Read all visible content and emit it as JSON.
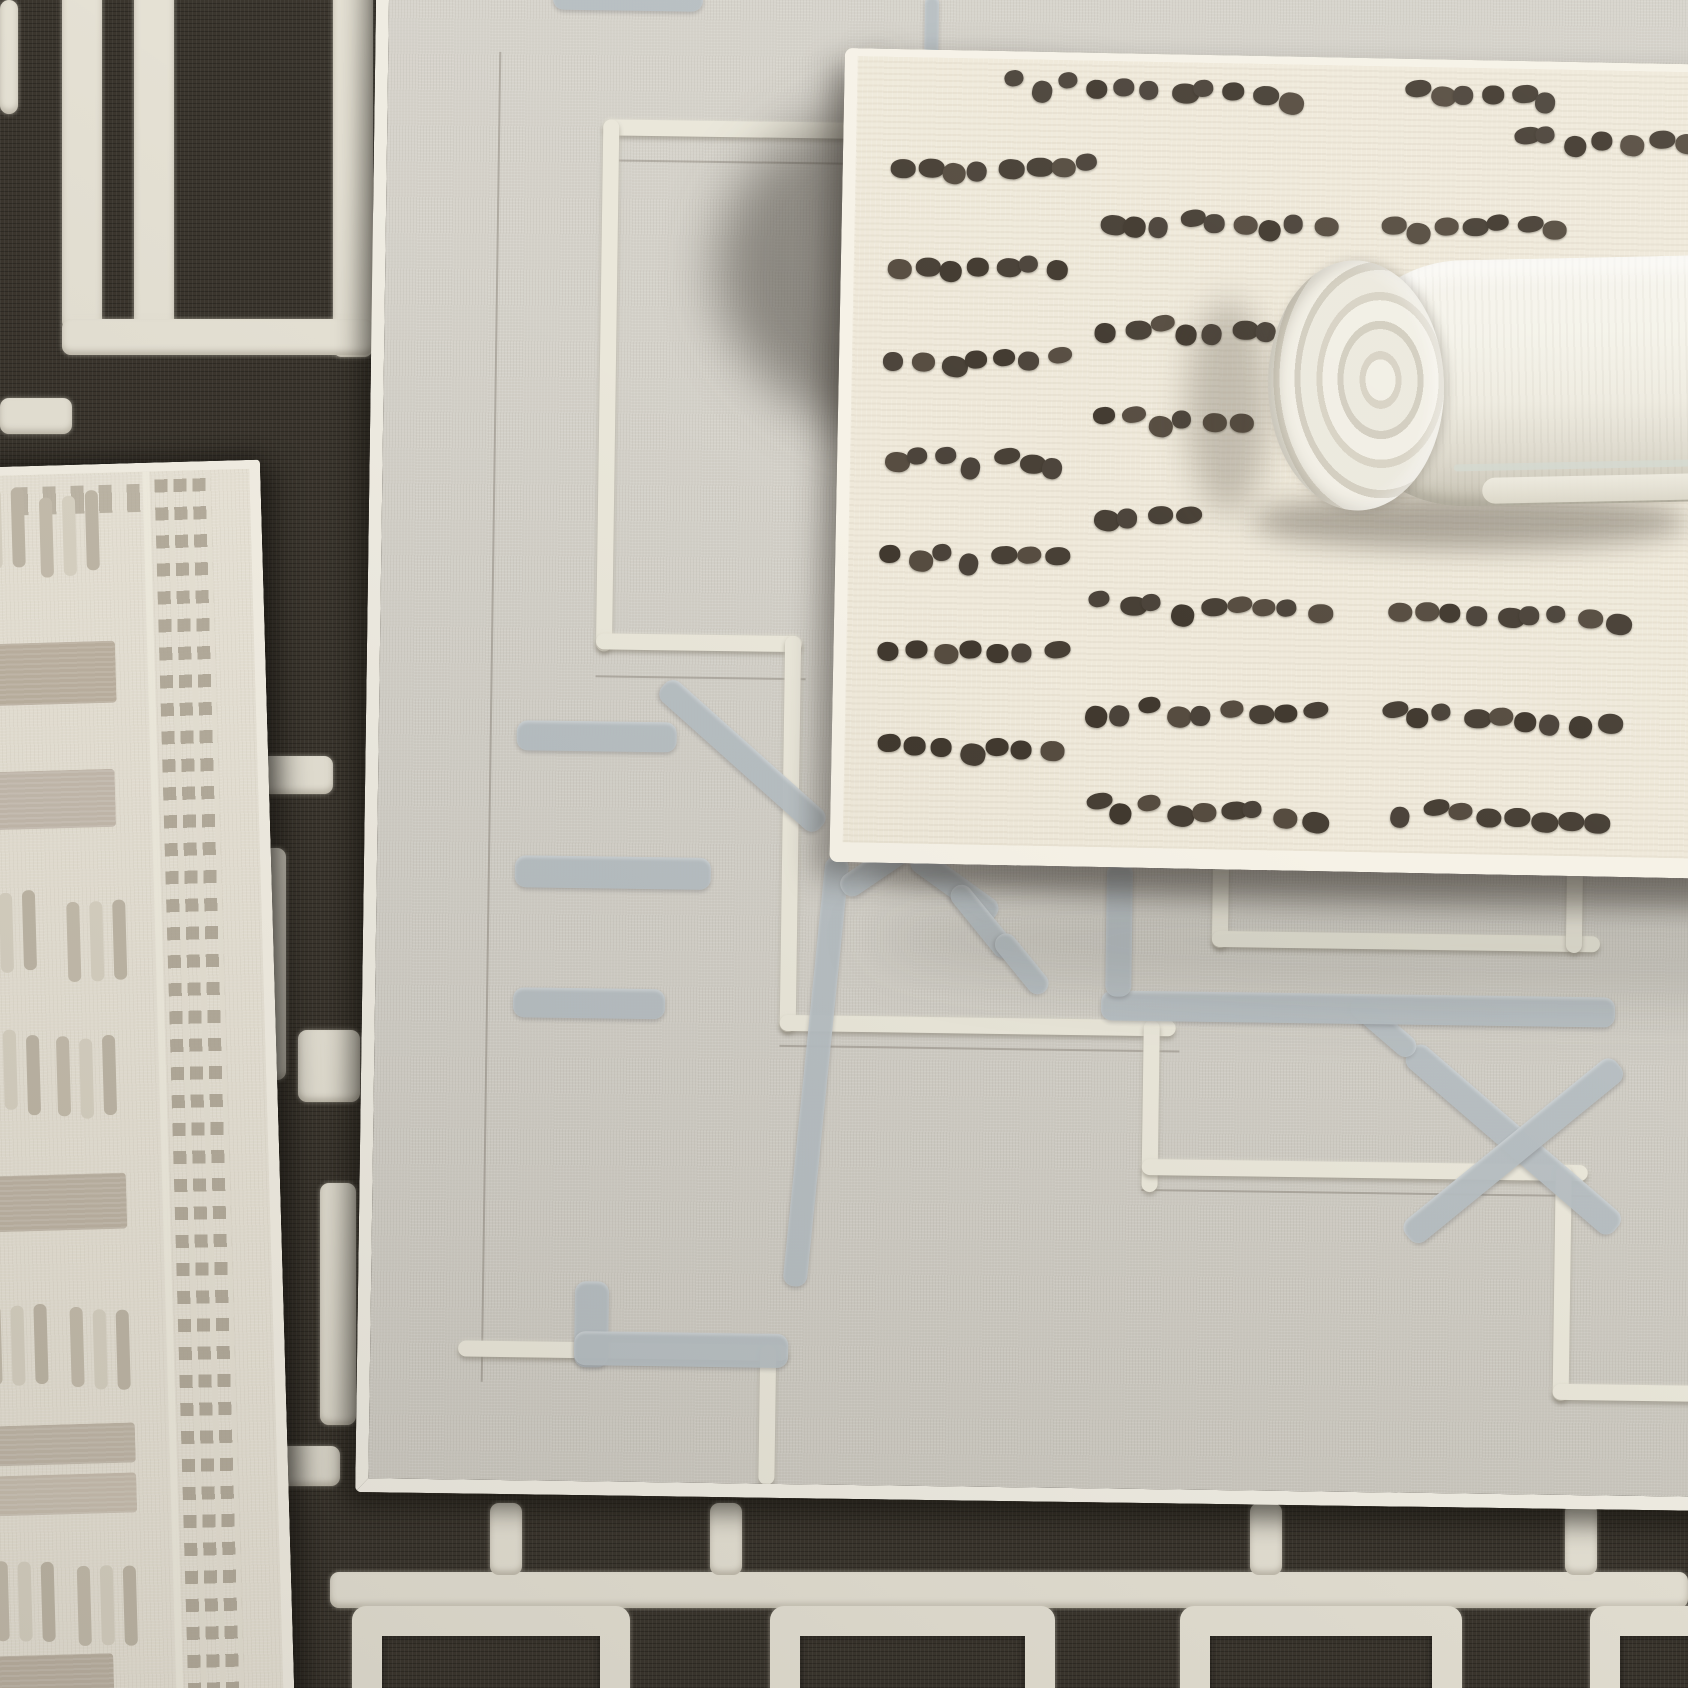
{
  "palette": {
    "dark_rug_base": "#3a352d",
    "dark_rug_pattern": "#e5e1d4",
    "gray_rug_base": "#d2cfc7",
    "gray_rug_lines": "#eae7da",
    "gray_rug_motifs": "#b6bec2",
    "cream_rug_base": "#efe9da",
    "cream_rug_dots": "#4a4238",
    "beige_rug_base": "#e8e3d6",
    "beige_rug_taupe": "#bcb2a2",
    "roll_fabric": "#f4f2e9"
  },
  "dark_rug": {
    "bars": [
      {
        "x": 0,
        "y": 0,
        "w": 18,
        "h": 114
      },
      {
        "x": 62,
        "y": -20,
        "w": 40,
        "h": 350
      },
      {
        "x": 134,
        "y": -20,
        "w": 40,
        "h": 350
      },
      {
        "x": 333,
        "y": -20,
        "w": 40,
        "h": 377
      },
      {
        "x": 62,
        "y": 319,
        "w": 311,
        "h": 36
      },
      {
        "x": 0,
        "y": 398,
        "w": 72,
        "h": 36
      },
      {
        "x": 243,
        "y": 756,
        "w": 90,
        "h": 38
      },
      {
        "x": 252,
        "y": 848,
        "w": 34,
        "h": 232
      },
      {
        "x": 298,
        "y": 1030,
        "w": 62,
        "h": 72
      },
      {
        "x": 320,
        "y": 1183,
        "w": 36,
        "h": 242
      },
      {
        "x": 248,
        "y": 1446,
        "w": 92,
        "h": 40
      },
      {
        "x": 330,
        "y": 1572,
        "w": 1358,
        "h": 36
      },
      {
        "x": 490,
        "y": 1503,
        "w": 32,
        "h": 72
      },
      {
        "x": 710,
        "y": 1503,
        "w": 32,
        "h": 72
      },
      {
        "x": 1250,
        "y": 1503,
        "w": 32,
        "h": 72
      },
      {
        "x": 1565,
        "y": 1503,
        "w": 32,
        "h": 72
      }
    ],
    "frames": [
      {
        "x": 352,
        "y": 1606,
        "w": 278,
        "h": 130
      },
      {
        "x": 770,
        "y": 1606,
        "w": 285,
        "h": 130
      },
      {
        "x": 1180,
        "y": 1606,
        "w": 282,
        "h": 130
      },
      {
        "x": 1590,
        "y": 1606,
        "w": 160,
        "h": 130
      }
    ]
  },
  "beige_rug": {
    "blocks": [
      {
        "x": 0,
        "y": 168,
        "w": 152,
        "h": 62,
        "c": "#bdb2a1"
      },
      {
        "x": 0,
        "y": 296,
        "w": 148,
        "h": 58,
        "c": "#c5bbae"
      },
      {
        "x": 0,
        "y": 700,
        "w": 148,
        "h": 56,
        "c": "#bfb5a5"
      },
      {
        "x": 0,
        "y": 950,
        "w": 150,
        "h": 40,
        "c": "#c2b8a9"
      },
      {
        "x": 0,
        "y": 1000,
        "w": 150,
        "h": 40,
        "c": "#cac0b1"
      },
      {
        "x": 0,
        "y": 1180,
        "w": 122,
        "h": 46,
        "c": "#bdb3a3"
      }
    ],
    "dash_groups": [
      {
        "x": 6,
        "y": 16
      },
      {
        "x": 80,
        "y": 20
      },
      {
        "x": 6,
        "y": 416
      },
      {
        "x": 96,
        "y": 428
      },
      {
        "x": 6,
        "y": 556
      },
      {
        "x": 82,
        "y": 562
      },
      {
        "x": 6,
        "y": 828
      },
      {
        "x": 88,
        "y": 836
      },
      {
        "x": 6,
        "y": 1086
      },
      {
        "x": 88,
        "y": 1092
      }
    ],
    "dash": {
      "bar_w": 13,
      "bar_h": 80,
      "gap": 10,
      "colors": [
        "#c6beae",
        "#d9d3c4",
        "#c0b8a8"
      ]
    }
  },
  "gray_rug": {
    "white_lines": [
      {
        "x": 216,
        "y": 186,
        "w": 292,
        "h": 16
      },
      {
        "x": 216,
        "y": 186,
        "w": 16,
        "h": 532
      },
      {
        "x": 216,
        "y": 700,
        "w": 206,
        "h": 16
      },
      {
        "x": 405,
        "y": 700,
        "w": 16,
        "h": 396
      },
      {
        "x": 405,
        "y": 1079,
        "w": 396,
        "h": 16
      },
      {
        "x": 769,
        "y": 1079,
        "w": 16,
        "h": 172
      },
      {
        "x": 769,
        "y": 1218,
        "w": 446,
        "h": 16
      },
      {
        "x": 1183,
        "y": 1218,
        "w": 16,
        "h": 236
      },
      {
        "x": 1183,
        "y": 1437,
        "w": 210,
        "h": 16
      },
      {
        "x": 836,
        "y": 920,
        "w": 16,
        "h": 86
      },
      {
        "x": 836,
        "y": 989,
        "w": 388,
        "h": 16
      },
      {
        "x": 1190,
        "y": 922,
        "w": 16,
        "h": 84
      },
      {
        "x": 88,
        "y": 1409,
        "w": 330,
        "h": 16
      },
      {
        "x": 390,
        "y": 1409,
        "w": 16,
        "h": 140
      }
    ],
    "guide_lines": [
      {
        "x": 111,
        "y": 120,
        "w": 2,
        "h": 1330
      },
      {
        "x": 232,
        "y": 226,
        "w": 630,
        "h": 2
      },
      {
        "x": 405,
        "y": 1109,
        "w": 400,
        "h": 2
      },
      {
        "x": 769,
        "y": 1248,
        "w": 450,
        "h": 2
      },
      {
        "x": 216,
        "y": 742,
        "w": 210,
        "h": 2
      }
    ],
    "motifs": [
      {
        "x": 164,
        "y": 55,
        "w": 150,
        "h": 22,
        "r": 0
      },
      {
        "x": 536,
        "y": 58,
        "w": 14,
        "h": 60,
        "r": 0
      },
      {
        "x": 138,
        "y": 788,
        "w": 160,
        "h": 30,
        "r": 0
      },
      {
        "x": 138,
        "y": 923,
        "w": 196,
        "h": 32,
        "r": 0
      },
      {
        "x": 138,
        "y": 1055,
        "w": 152,
        "h": 30,
        "r": 0
      },
      {
        "x": 284,
        "y": 738,
        "w": 212,
        "h": 26,
        "r": 41
      },
      {
        "x": 430,
        "y": 918,
        "w": 24,
        "h": 432,
        "r": 5
      },
      {
        "x": 204,
        "y": 1348,
        "w": 34,
        "h": 86,
        "r": 0
      },
      {
        "x": 204,
        "y": 1398,
        "w": 214,
        "h": 34,
        "r": 0
      },
      {
        "x": 466,
        "y": 942,
        "w": 102,
        "h": 24,
        "r": -35
      },
      {
        "x": 536,
        "y": 906,
        "w": 102,
        "h": 24,
        "r": 35
      },
      {
        "x": 1036,
        "y": 1092,
        "w": 272,
        "h": 28,
        "r": 40
      },
      {
        "x": 1036,
        "y": 1278,
        "w": 272,
        "h": 28,
        "r": -40
      },
      {
        "x": 978,
        "y": 1046,
        "w": 80,
        "h": 22,
        "r": 40
      },
      {
        "x": 726,
        "y": 1050,
        "w": 514,
        "h": 30,
        "r": 0
      },
      {
        "x": 730,
        "y": 922,
        "w": 26,
        "h": 134,
        "r": 0
      },
      {
        "x": 578,
        "y": 938,
        "w": 88,
        "h": 22,
        "r": 50
      },
      {
        "x": 623,
        "y": 986,
        "w": 72,
        "h": 22,
        "r": 50
      }
    ],
    "cast_shadows": [
      {
        "x": 330,
        "y": 140,
        "w": 540,
        "h": 380,
        "a": 0.45,
        "b": 26
      },
      {
        "x": 462,
        "y": 108,
        "w": 52,
        "h": 780,
        "a": 0.26,
        "b": 16
      },
      {
        "x": 492,
        "y": 908,
        "w": 1300,
        "h": 56,
        "a": 0.32,
        "b": 12
      },
      {
        "x": 492,
        "y": 940,
        "w": 1300,
        "h": 120,
        "a": 0.12,
        "b": 28
      }
    ]
  },
  "cream_rug": {
    "dot_rows": [
      {
        "y": 16,
        "segs": [
          [
            150,
            295
          ],
          [
            545,
            165
          ]
        ]
      },
      {
        "y": 62,
        "segs": [
          [
            655,
            190
          ]
        ]
      },
      {
        "y": 102,
        "segs": [
          [
            33,
            205
          ]
        ]
      },
      {
        "y": 152,
        "segs": [
          [
            243,
            235
          ],
          [
            525,
            190
          ]
        ]
      },
      {
        "y": 200,
        "segs": [
          [
            33,
            195
          ]
        ]
      },
      {
        "y": 260,
        "segs": [
          [
            243,
            225
          ]
        ]
      },
      {
        "y": 295,
        "segs": [
          [
            33,
            190
          ]
        ]
      },
      {
        "y": 350,
        "segs": [
          [
            243,
            160
          ]
        ]
      },
      {
        "y": 393,
        "segs": [
          [
            33,
            185
          ]
        ]
      },
      {
        "y": 445,
        "segs": [
          [
            243,
            120
          ]
        ]
      },
      {
        "y": 490,
        "segs": [
          [
            33,
            195
          ]
        ]
      },
      {
        "y": 535,
        "segs": [
          [
            243,
            255
          ],
          [
            540,
            230
          ]
        ]
      },
      {
        "y": 585,
        "segs": [
          [
            33,
            195
          ]
        ]
      },
      {
        "y": 640,
        "segs": [
          [
            240,
            250
          ],
          [
            535,
            255
          ]
        ]
      },
      {
        "y": 680,
        "segs": [
          [
            33,
            190
          ]
        ]
      },
      {
        "y": 737,
        "segs": [
          [
            240,
            255
          ],
          [
            550,
            205
          ]
        ]
      }
    ],
    "dot_colors": [
      "#4b433a",
      "#41392f",
      "#564c40",
      "#473f35"
    ],
    "dot_pitch": 27
  },
  "roll": {
    "ring_count": 4
  }
}
